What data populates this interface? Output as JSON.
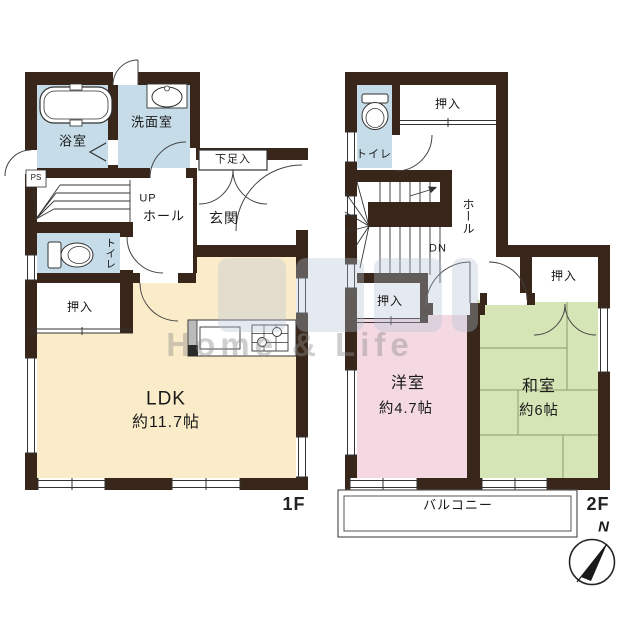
{
  "colors": {
    "wall": "#372619",
    "wet_room": "#c6dde9",
    "ldk": "#faecc9",
    "western_room": "#f4d9e3",
    "japanese_room": "#d5e5b6"
  },
  "floor1": {
    "floor_label": "1F",
    "bath": "浴室",
    "washroom": "洗面室",
    "shoe_cabinet": "下足入",
    "entrance": "玄関",
    "hall": "ホール",
    "stairs_up": "UP",
    "toilet": "トイレ",
    "closet": "押入",
    "pipe_space": "PS",
    "ldk": "LDK",
    "ldk_size": "約11.7帖"
  },
  "floor2": {
    "floor_label": "2F",
    "toilet": "トイレ",
    "closet_north": "押入",
    "hall": "ホール",
    "stairs_down": "DN",
    "closet_west": "押入",
    "closet_east": "押入",
    "western_room": "洋室",
    "western_room_size": "約4.7帖",
    "japanese_room": "和室",
    "japanese_room_size": "約6帖",
    "balcony": "バルコニー"
  },
  "compass": {
    "north": "N"
  },
  "watermark": {
    "text": "Home & Life"
  }
}
